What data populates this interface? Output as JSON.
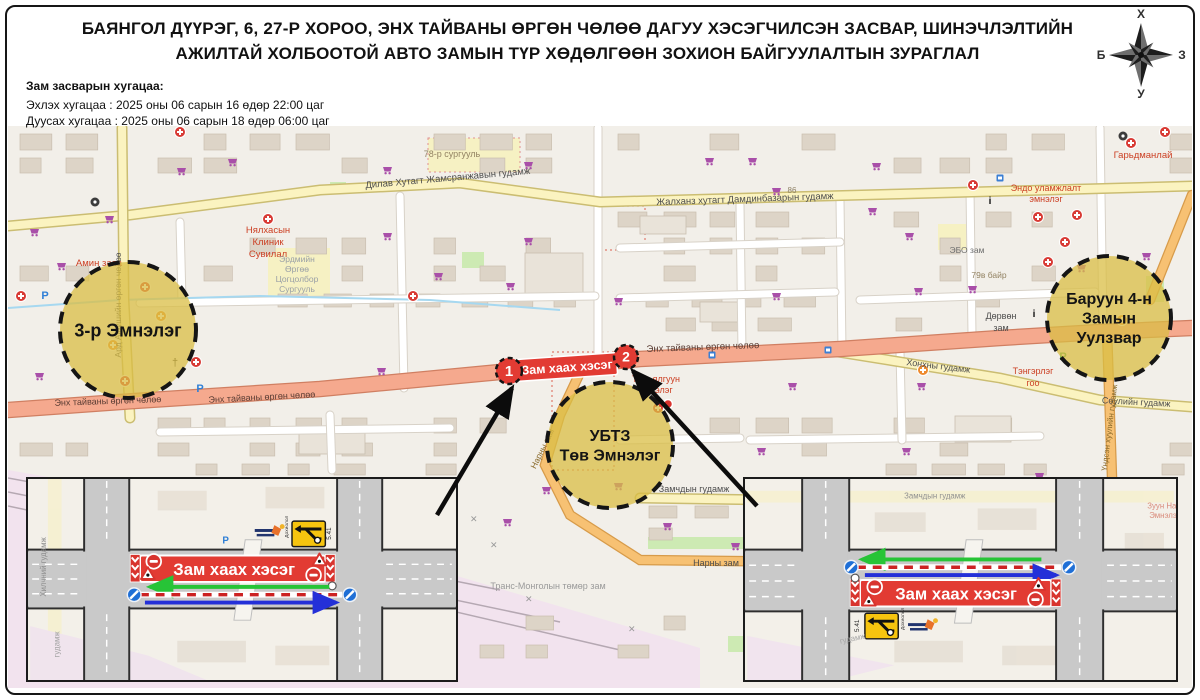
{
  "header": {
    "title": "БАЯНГОЛ ДҮҮРЭГ, 6, 27-Р ХОРОО, ЭНХ ТАЙВАНЫ ӨРГӨН ЧӨЛӨӨ ДАГУУ ХЭСЭГЧИЛСЭН ЗАСВАР, ШИНЭЧЛЭЛТИЙН АЖИЛТАЙ ХОЛБООТОЙ АВТО ЗАМЫН ТҮР ХӨДӨЛГӨӨН ЗОХИОН БАЙГУУЛАЛТЫН ЗУРАГЛАЛ",
    "schedule_heading": "Зам засварын хугацаа:",
    "schedule_start": "Эхлэх хугацаа : 2025 оны 06 сарын 16 өдөр 22:00 цаг",
    "schedule_end": "Дуусах хугацаа : 2025 оны 06 сарын 18 өдөр 06:00 цаг"
  },
  "compass": {
    "north": "Х",
    "east": "З",
    "south": "У",
    "west": "Б"
  },
  "closure": {
    "banner_label": "Зам хаах хэсэг",
    "marker_1": "1",
    "marker_2": "2"
  },
  "zones": [
    {
      "name": "hospital-3",
      "lines": [
        "3-р Эмнэлэг"
      ],
      "cx": 128,
      "cy": 330,
      "r": 68,
      "font": 18
    },
    {
      "name": "ubtz-central-hospital",
      "lines": [
        "УБТЗ",
        "Төв Эмнэлэг"
      ],
      "cx": 610,
      "cy": 445,
      "r": 63,
      "font": 16
    },
    {
      "name": "baruun-4-intersection",
      "lines": [
        "Баруун 4-н",
        "Замын",
        "Уулзвар"
      ],
      "cx": 1109,
      "cy": 318,
      "r": 62,
      "font": 16
    }
  ],
  "map_labels": [
    {
      "t": "Дилав Хутагт Жамсранжавын гудамж",
      "x": 448,
      "y": 181,
      "r": -5,
      "c": "#4d4d4d",
      "s": 9.5
    },
    {
      "t": "Жалханз хутагт Дамдинбазарын гудамж",
      "x": 745,
      "y": 202,
      "r": -2,
      "c": "#4d4d4d",
      "s": 9.5
    },
    {
      "t": "86",
      "x": 792,
      "y": 193,
      "r": 0,
      "c": "#8d7f63",
      "s": 8
    },
    {
      "t": "78-р сургууль",
      "x": 452,
      "y": 157,
      "r": 0,
      "c": "#938363",
      "s": 9
    },
    {
      "t": "Эндо уламжлалт",
      "x": 1046,
      "y": 191,
      "r": 0,
      "c": "#cc4125",
      "s": 9
    },
    {
      "t": "эмнэлэг",
      "x": 1046,
      "y": 202,
      "r": 0,
      "c": "#cc4125",
      "s": 9
    },
    {
      "t": "Гарьдманлай",
      "x": 1143,
      "y": 158,
      "r": 0,
      "c": "#cc4125",
      "s": 9.5
    },
    {
      "t": "Нялхасын",
      "x": 268,
      "y": 233,
      "r": 0,
      "c": "#cc4125",
      "s": 9.5
    },
    {
      "t": "Клиник",
      "x": 268,
      "y": 245,
      "r": 0,
      "c": "#cc4125",
      "s": 9.5
    },
    {
      "t": "Сувилал",
      "x": 268,
      "y": 257,
      "r": 0,
      "c": "#cc4125",
      "s": 9.5
    },
    {
      "t": "Амин заяа",
      "x": 99,
      "y": 266,
      "r": 0,
      "c": "#cc4125",
      "s": 9.5
    },
    {
      "t": "Ард Аюушийн өргөн чөлөө",
      "x": 121,
      "y": 305,
      "r": -90,
      "c": "#4d4d4d",
      "s": 8.5
    },
    {
      "t": "Эрдмийн",
      "x": 297,
      "y": 262,
      "r": 0,
      "c": "#9aa0a6",
      "s": 8.5
    },
    {
      "t": "Өргөө",
      "x": 297,
      "y": 272,
      "r": 0,
      "c": "#9aa0a6",
      "s": 8.5
    },
    {
      "t": "Цогцолбор",
      "x": 297,
      "y": 282,
      "r": 0,
      "c": "#9aa0a6",
      "s": 8.5
    },
    {
      "t": "Сургууль",
      "x": 297,
      "y": 292,
      "r": 0,
      "c": "#9aa0a6",
      "s": 8.5
    },
    {
      "t": "ЭБО зам",
      "x": 967,
      "y": 253,
      "r": 0,
      "c": "#6d6d6d",
      "s": 8.5
    },
    {
      "t": "79в байр",
      "x": 989,
      "y": 278,
      "r": 0,
      "c": "#938363",
      "s": 8.5
    },
    {
      "t": "Энх тайваны өргөн чөлөө",
      "x": 108,
      "y": 404,
      "r": -2,
      "c": "#5a3c33",
      "s": 9
    },
    {
      "t": "Энх тайваны өргөн чөлөө",
      "x": 262,
      "y": 400,
      "r": -3,
      "c": "#5a3c33",
      "s": 9
    },
    {
      "t": "Энх тайваны өргөн чөлөө",
      "x": 703,
      "y": 350,
      "r": -2,
      "c": "#5a3c33",
      "s": 9.5
    },
    {
      "t": "Төгс ялгуун",
      "x": 656,
      "y": 382,
      "r": 0,
      "c": "#cc4125",
      "s": 9
    },
    {
      "t": "эмнэлэг",
      "x": 656,
      "y": 393,
      "r": 0,
      "c": "#cc4125",
      "s": 9
    },
    {
      "t": "Хонхны гудамж",
      "x": 938,
      "y": 369,
      "r": 7,
      "c": "#4d4d4d",
      "s": 9
    },
    {
      "t": "Дөрвөн",
      "x": 1001,
      "y": 319,
      "r": 0,
      "c": "#4d4d4d",
      "s": 9
    },
    {
      "t": "зам",
      "x": 1001,
      "y": 331,
      "r": 0,
      "c": "#4d4d4d",
      "s": 9
    },
    {
      "t": "Тэнгэрлэг",
      "x": 1033,
      "y": 374,
      "r": 0,
      "c": "#cc4125",
      "s": 9
    },
    {
      "t": "гоо",
      "x": 1033,
      "y": 386,
      "r": 0,
      "c": "#cc4125",
      "s": 9
    },
    {
      "t": "Сөулийн гудамж",
      "x": 1136,
      "y": 405,
      "r": 3,
      "c": "#4d4d4d",
      "s": 9
    },
    {
      "t": "Замчдын гудамж",
      "x": 694,
      "y": 492,
      "r": 0,
      "c": "#4d4d4d",
      "s": 9
    },
    {
      "t": "Нарны зам",
      "x": 716,
      "y": 566,
      "r": 0,
      "c": "#4d4d4d",
      "s": 9
    },
    {
      "t": "Нарны зам",
      "x": 545,
      "y": 450,
      "r": -64,
      "c": "#8a6a2a",
      "s": 8.5
    },
    {
      "t": "Транс-Монголын төмөр зам",
      "x": 548,
      "y": 589,
      "r": 0,
      "c": "#9a9a9a",
      "s": 9
    },
    {
      "t": "Үндсэн хуулийн гудамж",
      "x": 1112,
      "y": 428,
      "r": -83,
      "c": "#8a6a2a",
      "s": 8
    }
  ],
  "pois": [
    {
      "k": "cart",
      "x": 177,
      "y": 167
    },
    {
      "k": "cart",
      "x": 383,
      "y": 166
    },
    {
      "k": "cart",
      "x": 524,
      "y": 161
    },
    {
      "k": "cart",
      "x": 705,
      "y": 157
    },
    {
      "k": "cart",
      "x": 748,
      "y": 157
    },
    {
      "k": "cart",
      "x": 872,
      "y": 162
    },
    {
      "k": "cart",
      "x": 772,
      "y": 187
    },
    {
      "k": "cart",
      "x": 868,
      "y": 207
    },
    {
      "k": "cart",
      "x": 905,
      "y": 232
    },
    {
      "k": "cart",
      "x": 383,
      "y": 232
    },
    {
      "k": "cart",
      "x": 524,
      "y": 237
    },
    {
      "k": "cart",
      "x": 30,
      "y": 228
    },
    {
      "k": "cart",
      "x": 57,
      "y": 262
    },
    {
      "k": "cart",
      "x": 434,
      "y": 272
    },
    {
      "k": "cart",
      "x": 506,
      "y": 282
    },
    {
      "k": "cart",
      "x": 614,
      "y": 297
    },
    {
      "k": "cart",
      "x": 772,
      "y": 292
    },
    {
      "k": "cart",
      "x": 914,
      "y": 287
    },
    {
      "k": "cart",
      "x": 968,
      "y": 285
    },
    {
      "k": "cart",
      "x": 1077,
      "y": 264
    },
    {
      "k": "cart",
      "x": 35,
      "y": 372
    },
    {
      "k": "cart",
      "x": 377,
      "y": 367
    },
    {
      "k": "cart",
      "x": 521,
      "y": 367
    },
    {
      "k": "cart",
      "x": 788,
      "y": 382
    },
    {
      "k": "cart",
      "x": 917,
      "y": 382
    },
    {
      "k": "cart",
      "x": 1142,
      "y": 252
    },
    {
      "k": "cart",
      "x": 1035,
      "y": 472
    },
    {
      "k": "cart",
      "x": 902,
      "y": 447
    },
    {
      "k": "cart",
      "x": 757,
      "y": 447
    },
    {
      "k": "cart",
      "x": 614,
      "y": 482
    },
    {
      "k": "cart",
      "x": 663,
      "y": 522
    },
    {
      "k": "cart",
      "x": 731,
      "y": 542
    },
    {
      "k": "cart",
      "x": 105,
      "y": 215
    },
    {
      "k": "cart",
      "x": 228,
      "y": 158
    },
    {
      "k": "cart",
      "x": 503,
      "y": 518
    },
    {
      "k": "cart",
      "x": 542,
      "y": 486
    },
    {
      "k": "med",
      "x": 180,
      "y": 132
    },
    {
      "k": "med",
      "x": 268,
      "y": 219
    },
    {
      "k": "med",
      "x": 973,
      "y": 185
    },
    {
      "k": "med",
      "x": 1131,
      "y": 143
    },
    {
      "k": "med",
      "x": 1038,
      "y": 217
    },
    {
      "k": "med",
      "x": 1077,
      "y": 215
    },
    {
      "k": "med",
      "x": 1065,
      "y": 242
    },
    {
      "k": "med",
      "x": 1048,
      "y": 262
    },
    {
      "k": "med",
      "x": 145,
      "y": 287
    },
    {
      "k": "med",
      "x": 196,
      "y": 362
    },
    {
      "k": "med",
      "x": 125,
      "y": 381
    },
    {
      "k": "med",
      "x": 413,
      "y": 296
    },
    {
      "k": "med",
      "x": 658,
      "y": 408
    },
    {
      "k": "med",
      "x": 1165,
      "y": 132
    },
    {
      "k": "med",
      "x": 21,
      "y": 296
    },
    {
      "k": "oplus",
      "x": 161,
      "y": 316
    },
    {
      "k": "oplus",
      "x": 113,
      "y": 345
    },
    {
      "k": "oplus",
      "x": 923,
      "y": 370
    },
    {
      "k": "oplus",
      "x": 1122,
      "y": 320
    },
    {
      "k": "park",
      "x": 45,
      "y": 295
    },
    {
      "k": "park",
      "x": 200,
      "y": 388
    },
    {
      "k": "parkg",
      "x": 1063,
      "y": 356
    },
    {
      "k": "bus",
      "x": 712,
      "y": 355
    },
    {
      "k": "bus",
      "x": 828,
      "y": 350
    },
    {
      "k": "bus",
      "x": 1000,
      "y": 178
    },
    {
      "k": "info",
      "x": 990,
      "y": 200
    },
    {
      "k": "info",
      "x": 1034,
      "y": 313
    },
    {
      "k": "church",
      "x": 175,
      "y": 362
    },
    {
      "k": "wheel",
      "x": 95,
      "y": 202
    },
    {
      "k": "wheel",
      "x": 1123,
      "y": 136
    }
  ],
  "insets": {
    "banner_label": "Зам хаах хэсэг",
    "detour_code": "5.41",
    "sign_caption": "Дохиолол",
    "left_bg_labels": [
      {
        "t": "Хилчний гудамж",
        "x": 16,
        "y": 120,
        "r": -90,
        "c": "#8f8f8f"
      },
      {
        "t": "гудамж",
        "x": 30,
        "y": 182,
        "r": -90,
        "c": "#a5a5a5"
      },
      {
        "t": "P",
        "x": 196,
        "y": 66,
        "r": 0,
        "c": "#2f7fd6"
      }
    ],
    "right_bg_labels": [
      {
        "t": "Замчдын гудамж",
        "x": 160,
        "y": 20,
        "r": 0,
        "c": "#8f8f8f"
      },
      {
        "t": "Зуун Наст",
        "x": 408,
        "y": 30,
        "r": 0,
        "c": "#d98a7a"
      },
      {
        "t": "Эмнэлэг",
        "x": 410,
        "y": 40,
        "r": 0,
        "c": "#d98a7a"
      },
      {
        "t": "гудамж",
        "x": 95,
        "y": 168,
        "r": -12,
        "c": "#a5a5a5"
      }
    ]
  },
  "colors": {
    "closure_red": "#e23b33",
    "zone_yellow": "#d9bd44",
    "map_bg": "#f2efe9",
    "main_road": "#f5a98e",
    "secondary_road": "#fbf3c0",
    "tertiary_road": "#f7c173",
    "rail_area": "#f2e3ee",
    "green_arrow": "#27c437",
    "blue_arrow": "#2430d8"
  }
}
